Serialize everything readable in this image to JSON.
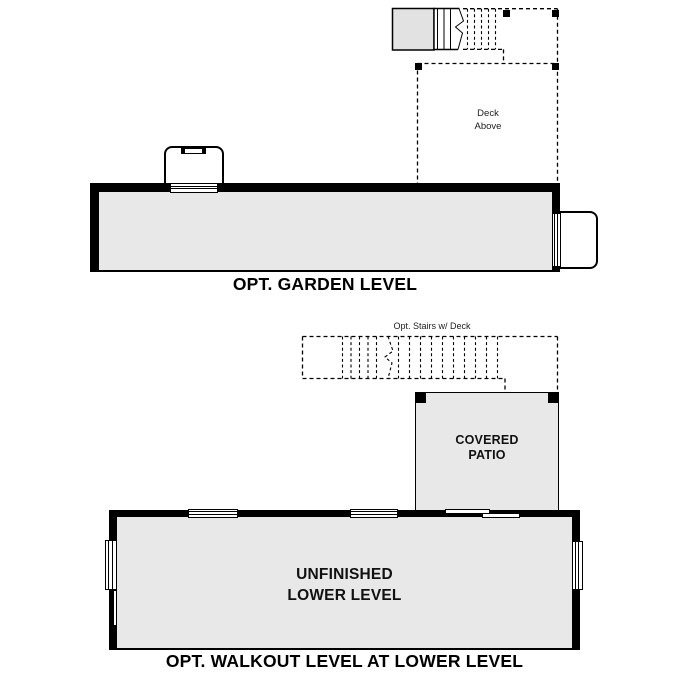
{
  "style": {
    "background": "#ffffff",
    "line_color": "#000000",
    "room_fill": "#e8e8e8",
    "stoop_fill": "#e2e2e2"
  },
  "garden_level": {
    "title": "OPT. GARDEN LEVEL",
    "deck_label": {
      "line1": "Deck",
      "line2": "Above"
    }
  },
  "walkout_level": {
    "title": "OPT. WALKOUT LEVEL AT LOWER LEVEL",
    "stairs_label": "Opt. Stairs w/ Deck",
    "patio_label": {
      "line1": "COVERED",
      "line2": "PATIO"
    },
    "room_label": {
      "line1": "UNFINISHED",
      "line2": "LOWER LEVEL"
    }
  }
}
